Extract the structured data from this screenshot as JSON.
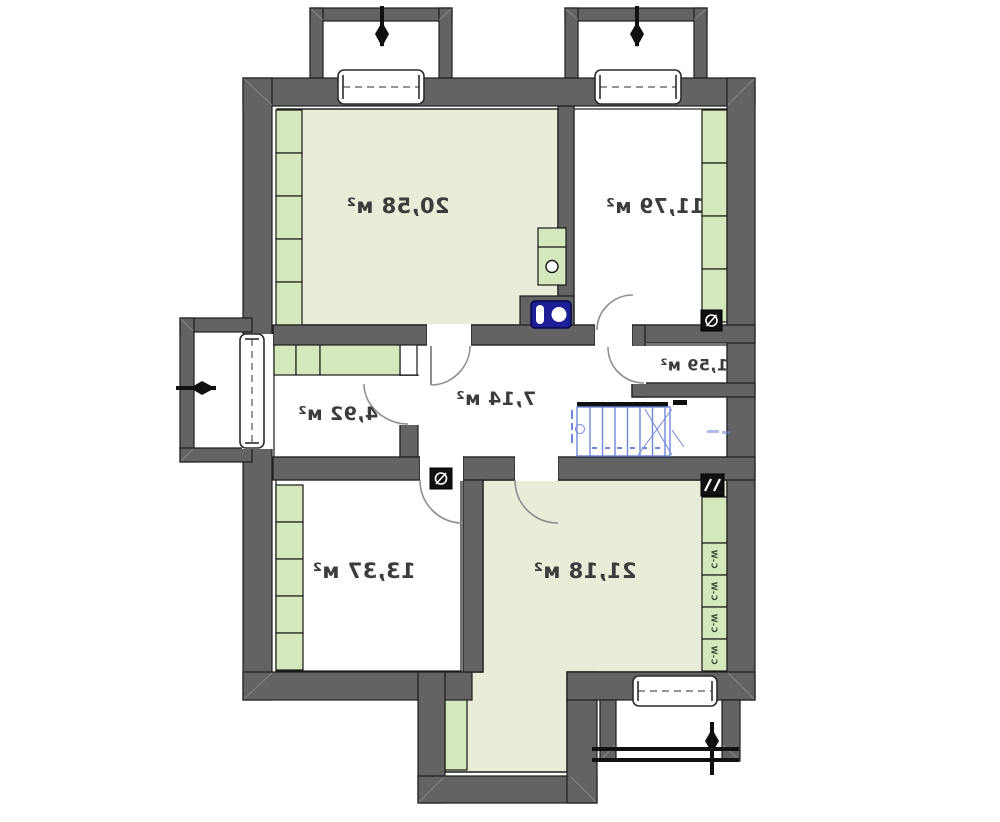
{
  "plan": {
    "title": "floor-plan",
    "mirrored": true,
    "rooms": [
      {
        "area": "20,58 м²"
      },
      {
        "area": "11,79 м²"
      },
      {
        "area": "1,59 м²"
      },
      {
        "area": "4,92 м²"
      },
      {
        "area": "7,14 м²"
      },
      {
        "area": "13,37 м²"
      },
      {
        "area": "21,18 м²"
      }
    ],
    "wall_unit_labels": [
      "C-W",
      "C-W",
      "C-W",
      "C-W"
    ]
  },
  "colors": {
    "wall": "#636363",
    "wall_outline": "#1d1d1d",
    "room_tint": "#e9ecd8",
    "green_unit": "#d5e8bd",
    "stair_blue": "#6f87dd",
    "fixture_navy": "#1e1e96",
    "label_text": "#3c3c3c",
    "door_arc": "#8f8f8f"
  }
}
